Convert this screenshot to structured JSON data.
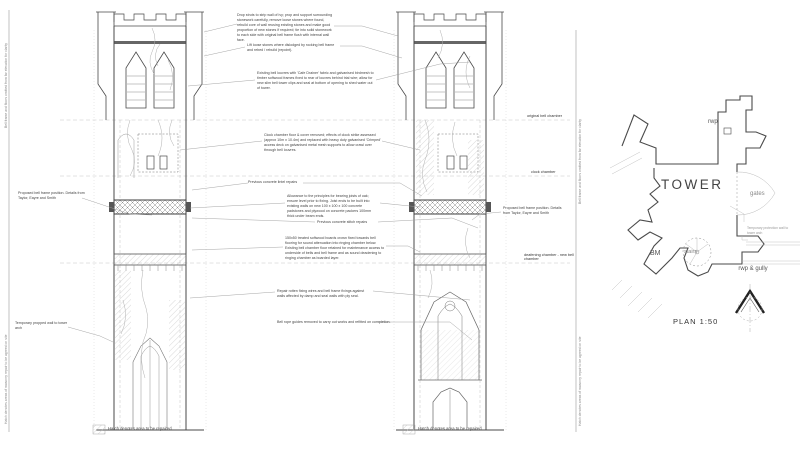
{
  "colors": {
    "ink": "#3a3a3a",
    "light_line": "#999999",
    "hatch": "#c9c9c9"
  },
  "annotations": {
    "top_note": "Drop struts to strip wall of ivy; prop and support surrounding stonework carefully, remove loose stones where found, rebuild core of wall reusing existing stones and make good proportion of new stones if required; tie into solid stonework to each side with original bell frame flush with internal wall face.",
    "lift_note": "Lift loose stones where dislodged by rocking bell frame and rebed / rebuild (repoint).",
    "louvre_note": "Existing bell louvres with 'Cafe Drainer' fabric and galvanised birdmesh to timber softwood frames fixed to rear of louvres behind trial wire; allow for new slim bell tower clips and seal at bottom of opening to shed water out of tower.",
    "clock_note": "Clock chamber floor & cover removed; effects of clock strike assessed (approx 10m x 10.4m) and replaced with heavy duty galvanised 'Crimped' access deck on galvanised metal mesh supports to allow crawl over through bell louvres.",
    "previous_repair_1": "Previous concrete lintel repairs",
    "joist_note": "Allowance to the principles for bearing joists of oak; ensure level prior to fixing. Joist ends to be built into existing walls on new 100 x 100 x 100 concrete padstones and plywood on concrete packers 100mm thick under beam ends.",
    "previous_repair_2": "Previous concrete stitch repairs",
    "floor_note": "150x50 treated softwood boards crown fixed towards bell flooring for sound attenuation into ringing chamber below. Existing bell chamber floor retained for maintenance access to underside of bells and bell frame and as sound deadening to ringing chamber as boarded layer.",
    "damp_note": "Repair rotten fixing wires and bell frame fixings against walls affected by damp and seal walls with ply seal.",
    "ropes_note": "Bell rope guides removed to carry out works and refitted on completion.",
    "frame_note": "Proposed bell frame position. Details from Taylor, Eayre and Smith",
    "arch_note": "Temporary propped wall to tower arch"
  },
  "levels": {
    "original_bell_chamber": "original bell chamber",
    "clock_chamber": "clock chamber",
    "deafening_chamber": "deafening chamber - new bell chamber"
  },
  "plan": {
    "title": "TOWER",
    "scale_label": "PLAN 1:50",
    "rwp_label": "rwp",
    "gates_label": "gates",
    "bm_label": "BM",
    "stairs_label": "stairs",
    "rwp_gully_label": "rwp & gully",
    "protection_note": "Temporary protection wall to tower arch"
  },
  "footer": {
    "hatch_note": "Hatch denotes area to be repaired"
  },
  "margins": {
    "note_top": "Bell frame and floors omitted from far elevation for clarity",
    "note_bottom": "Hatch denotes areas of masonry repair to be agreed on site"
  }
}
